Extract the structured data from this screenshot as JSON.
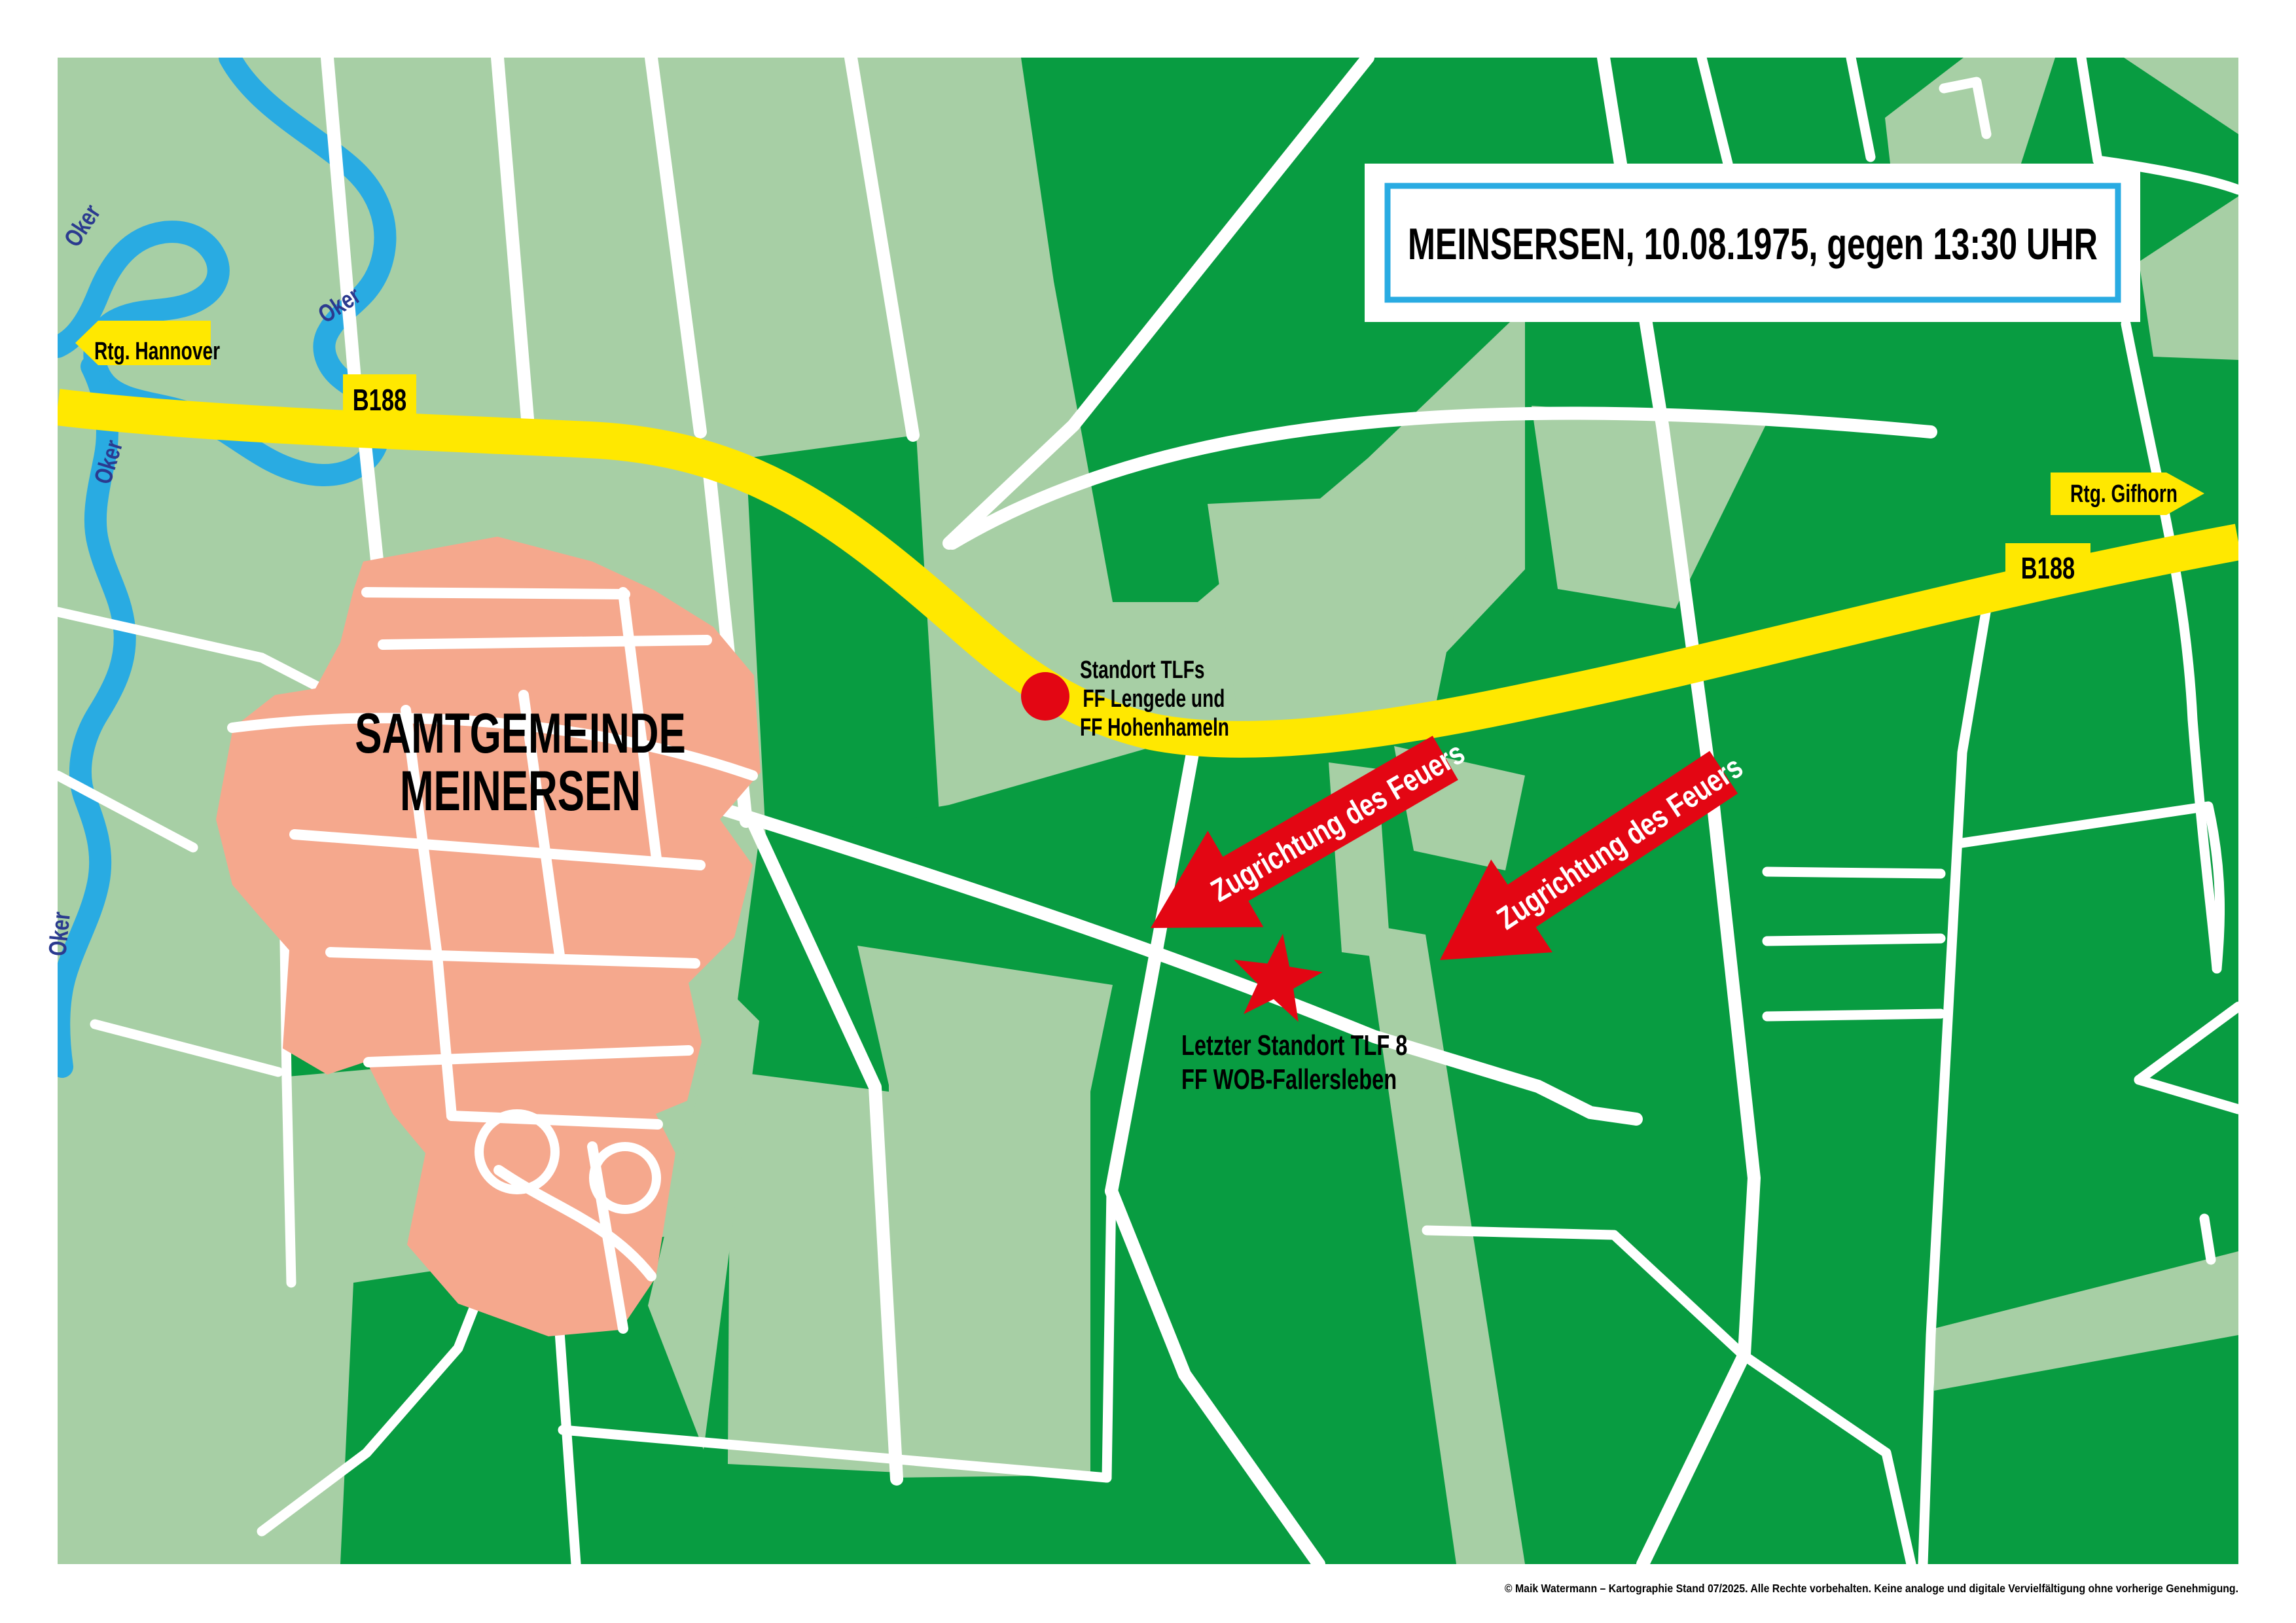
{
  "title_box": {
    "text": "MEINSERSEN, 10.08.1975, gegen 13:30 UHR",
    "border_color": "#29ABE2"
  },
  "signs": {
    "direction_west": "Rtg. Hannover",
    "direction_east": "Rtg. Gifhorn",
    "road_number": "B188"
  },
  "river": {
    "name": "Oker",
    "color": "#29ABE2",
    "label_color": "#2B3A8F"
  },
  "town": {
    "name_line1": "SAMTGEMEINDE",
    "name_line2": "MEINERSEN",
    "fill": "#F5A88D"
  },
  "markers": {
    "tlf_position": {
      "shape": "red-dot",
      "color": "#E30613",
      "label_line1": "Standort TLFs",
      "label_line2": "FF Lengede und",
      "label_line3": "FF  Hohenhameln"
    },
    "last_position": {
      "shape": "red-star",
      "color": "#E30613",
      "label_line1": "Letzter Standort TLF 8",
      "label_line2": "FF WOB-Fallersleben"
    }
  },
  "fire_arrows": {
    "label": "Zugrichtung des Feuers",
    "color": "#E30613",
    "count": 2
  },
  "map_colors": {
    "field_light_green": "#A7CFA5",
    "forest_dark_green": "#089C41",
    "road_white": "#FFFFFF",
    "highway_yellow": "#FFE800"
  },
  "footer": {
    "text": "© Maik Watermann – Kartographie Stand 07/2025. Alle Rechte vorbehalten. Keine analoge und digitale Vervielfältigung ohne vorherige Genehmigung."
  }
}
